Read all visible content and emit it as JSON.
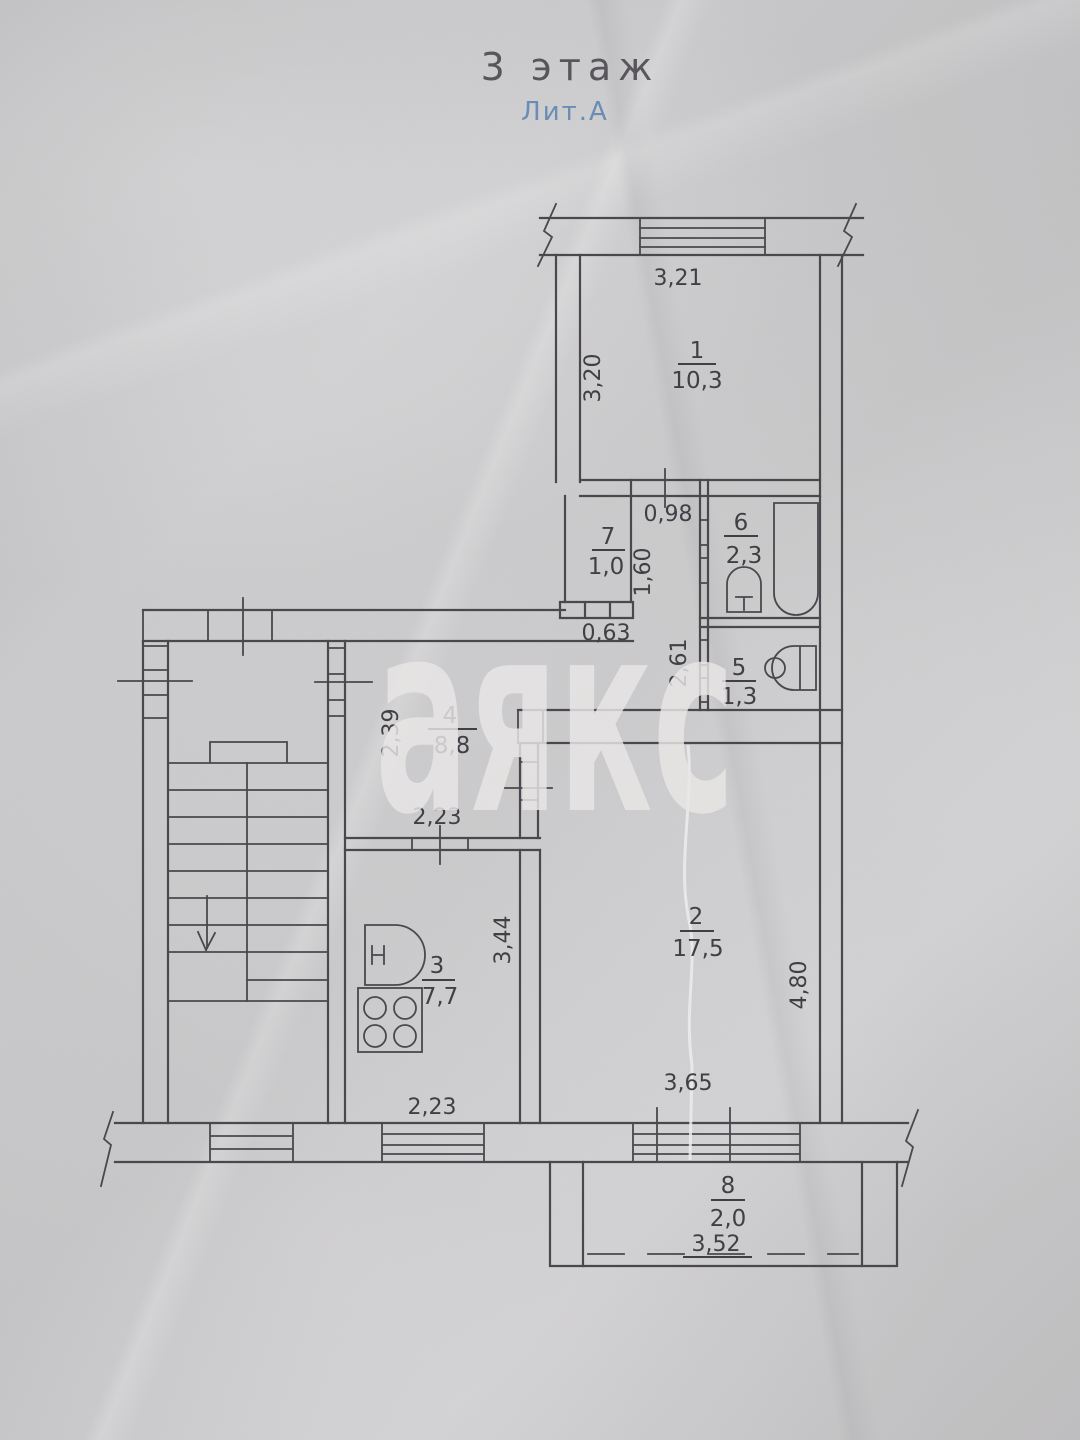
{
  "header": {
    "floor_label": "3 этаж",
    "litera_label": "Лит.А"
  },
  "watermark": {
    "text": "аякс"
  },
  "colors": {
    "line": "#4a484d",
    "label": "#413f44",
    "title": "#58565a",
    "litera": "#6b8cb5",
    "paper": "#d9d8da",
    "watermark": "#e9e7e6"
  },
  "rooms": [
    {
      "number": "1",
      "area": "10,3"
    },
    {
      "number": "2",
      "area": "17,5"
    },
    {
      "number": "3",
      "area": "7,7"
    },
    {
      "number": "4",
      "area": "8,8"
    },
    {
      "number": "5",
      "area": "1,3"
    },
    {
      "number": "6",
      "area": "2,3"
    },
    {
      "number": "7",
      "area": "1,0"
    },
    {
      "number": "8",
      "area": "2,0"
    }
  ],
  "dimensions": {
    "balcony_top": "3,21",
    "room1_left": "3,20",
    "corridor_width": "0,98",
    "corridor_length": "1,60",
    "closet_bottom": "0,63",
    "wc_corridor": "2,61",
    "hall_left": "2,39",
    "kitchen_top": "2,23",
    "kitchen_right": "3,44",
    "kitchen_bottom": "2,23",
    "room2_right": "4,80",
    "room2_bottom": "3,65",
    "balcony_bottom": "3,52"
  }
}
